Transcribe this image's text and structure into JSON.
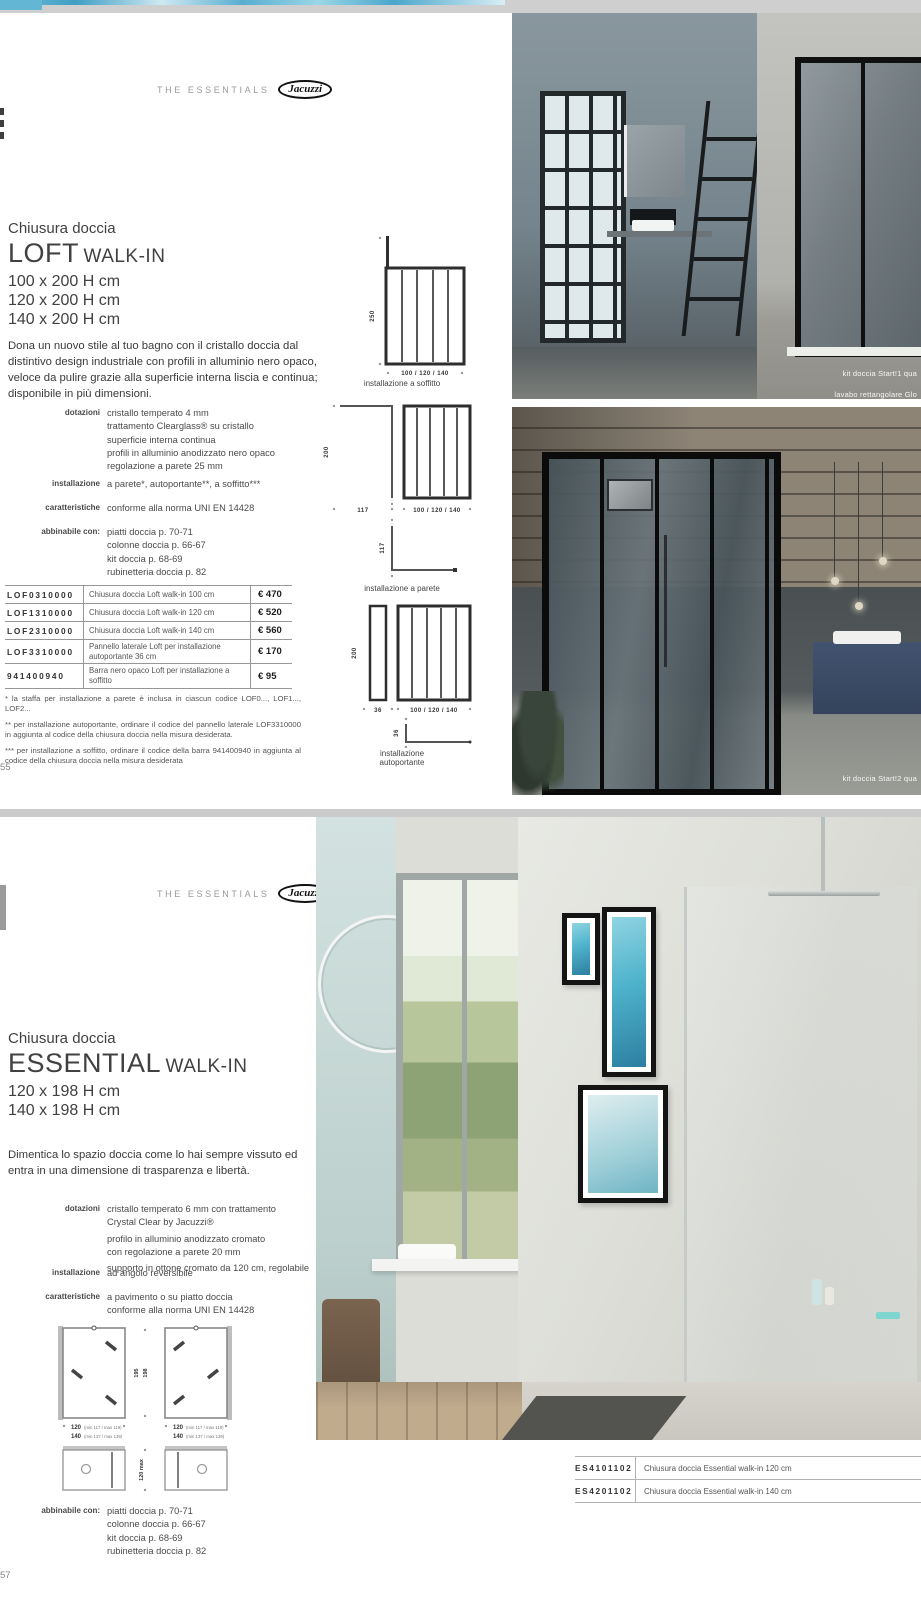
{
  "brand": {
    "series": "THE ESSENTIALS",
    "logo": "Jacuzzi"
  },
  "page1": {
    "page_number": "55",
    "kicker": "Chiusura doccia",
    "product": "LOFT",
    "product_type": "WALK-IN",
    "sizes": [
      "100 x 200 H cm",
      "120 x 200 H cm",
      "140 x 200 H cm"
    ],
    "description": "Dona un nuovo stile al tuo bagno con il cristallo doccia dal distintivo design industriale con profili in alluminio nero opaco, veloce da pulire grazie alla superficie interna liscia e continua; disponibile in più dimensioni.",
    "specs": [
      {
        "label": "dotazioni",
        "lines": [
          "cristallo temperato 4 mm",
          "trattamento Clearglass® su cristallo",
          "superficie interna continua",
          "profili in alluminio anodizzato nero opaco",
          "regolazione a parete 25 mm"
        ]
      },
      {
        "label": "installazione",
        "lines": [
          "a parete*, autoportante**, a soffitto***"
        ]
      },
      {
        "label": "caratteristiche",
        "lines": [
          "conforme alla norma UNI EN 14428"
        ]
      },
      {
        "label": "abbinabile con:",
        "lines": [
          "piatti doccia p. 70-71",
          "colonne doccia p. 66-67",
          "kit doccia p. 68-69",
          "rubinetteria doccia p. 82"
        ]
      }
    ],
    "price_table": {
      "rows": [
        {
          "code": "LOF0310000",
          "desc": "Chiusura doccia Loft walk-in 100 cm",
          "price": "€ 470"
        },
        {
          "code": "LOF1310000",
          "desc": "Chiusura doccia Loft walk-in 120 cm",
          "price": "€ 520"
        },
        {
          "code": "LOF2310000",
          "desc": "Chiusura doccia Loft walk-in 140 cm",
          "price": "€ 560"
        },
        {
          "code": "LOF3310000",
          "desc": "Pannello laterale Loft per installazione autoportante 36 cm",
          "price": "€ 170"
        },
        {
          "code": "941400940",
          "desc": "Barra nero opaco Loft per installazione a soffitto",
          "price": "€ 95"
        }
      ]
    },
    "footnotes": [
      "*  la staffa per installazione a parete è inclusa in ciascun codice LOF0..., LOF1..., LOF2...",
      "** per installazione autoportante, ordinare il codice del pannello laterale LOF3310000 in aggiunta al codice della chiusura doccia nella misura desiderata.",
      "*** per installazione a soffitto, ordinare il codice della barra 941400940 in aggiunta al codice della chiusura doccia nella misura desiderata"
    ],
    "diagrams": [
      {
        "caption": "installazione a soffitto",
        "height": "250",
        "width": "100 / 120 / 140"
      },
      {
        "caption": "installazione a parete",
        "height": "200",
        "wall_depth": "117",
        "width": "100 / 120 / 140",
        "plan_depth": "117"
      },
      {
        "caption": "installazione autoportante",
        "height": "200",
        "panel_width": "36",
        "width": "100 / 120 / 140",
        "plan_depth": "36"
      }
    ],
    "photos": {
      "top_caption_1": "kit doccia Start!1 qua",
      "top_caption_2": "lavabo rettangolare Glo",
      "bottom_caption": "kit doccia Start!2 qua"
    }
  },
  "page2": {
    "page_number": "57",
    "kicker": "Chiusura doccia",
    "product": "ESSENTIAL",
    "product_type": "WALK-IN",
    "sizes": [
      "120 x 198 H cm",
      "140 x 198 H cm"
    ],
    "description": "Dimentica lo spazio doccia come lo hai sempre vissuto ed entra in una dimensione di trasparenza e libertà.",
    "specs": [
      {
        "label": "dotazioni",
        "lines": [
          "cristallo temperato 6 mm con trattamento",
          "Crystal Clear by Jacuzzi®",
          "profilo in alluminio anodizzato cromato",
          "con regolazione a parete 20 mm",
          "supporto in ottone cromato da 120 cm, regolabile"
        ]
      },
      {
        "label": "installazione",
        "lines": [
          "ad angolo reversibile"
        ]
      },
      {
        "label": "caratteristiche",
        "lines": [
          "a pavimento o su piatto doccia",
          "conforme alla norma UNI EN 14428"
        ]
      },
      {
        "label": "abbinabile con:",
        "lines": [
          "piatti doccia p. 70-71",
          "colonne doccia p. 66-67",
          "kit doccia p. 68-69",
          "rubinetteria doccia p. 82"
        ]
      }
    ],
    "diagram": {
      "height_1": "195",
      "height_2": "198",
      "width_1": "120",
      "width_1_note": "(min 117 / max 119)",
      "width_2": "140",
      "width_2_note": "(min 137 / max 139)",
      "plan_width": "120 max"
    },
    "codes_table": {
      "rows": [
        {
          "code": "ES4101102",
          "desc": "Chiusura doccia Essential walk-in 120 cm"
        },
        {
          "code": "ES4201102",
          "desc": "Chiusura doccia Essential walk-in 140 cm"
        }
      ]
    }
  }
}
